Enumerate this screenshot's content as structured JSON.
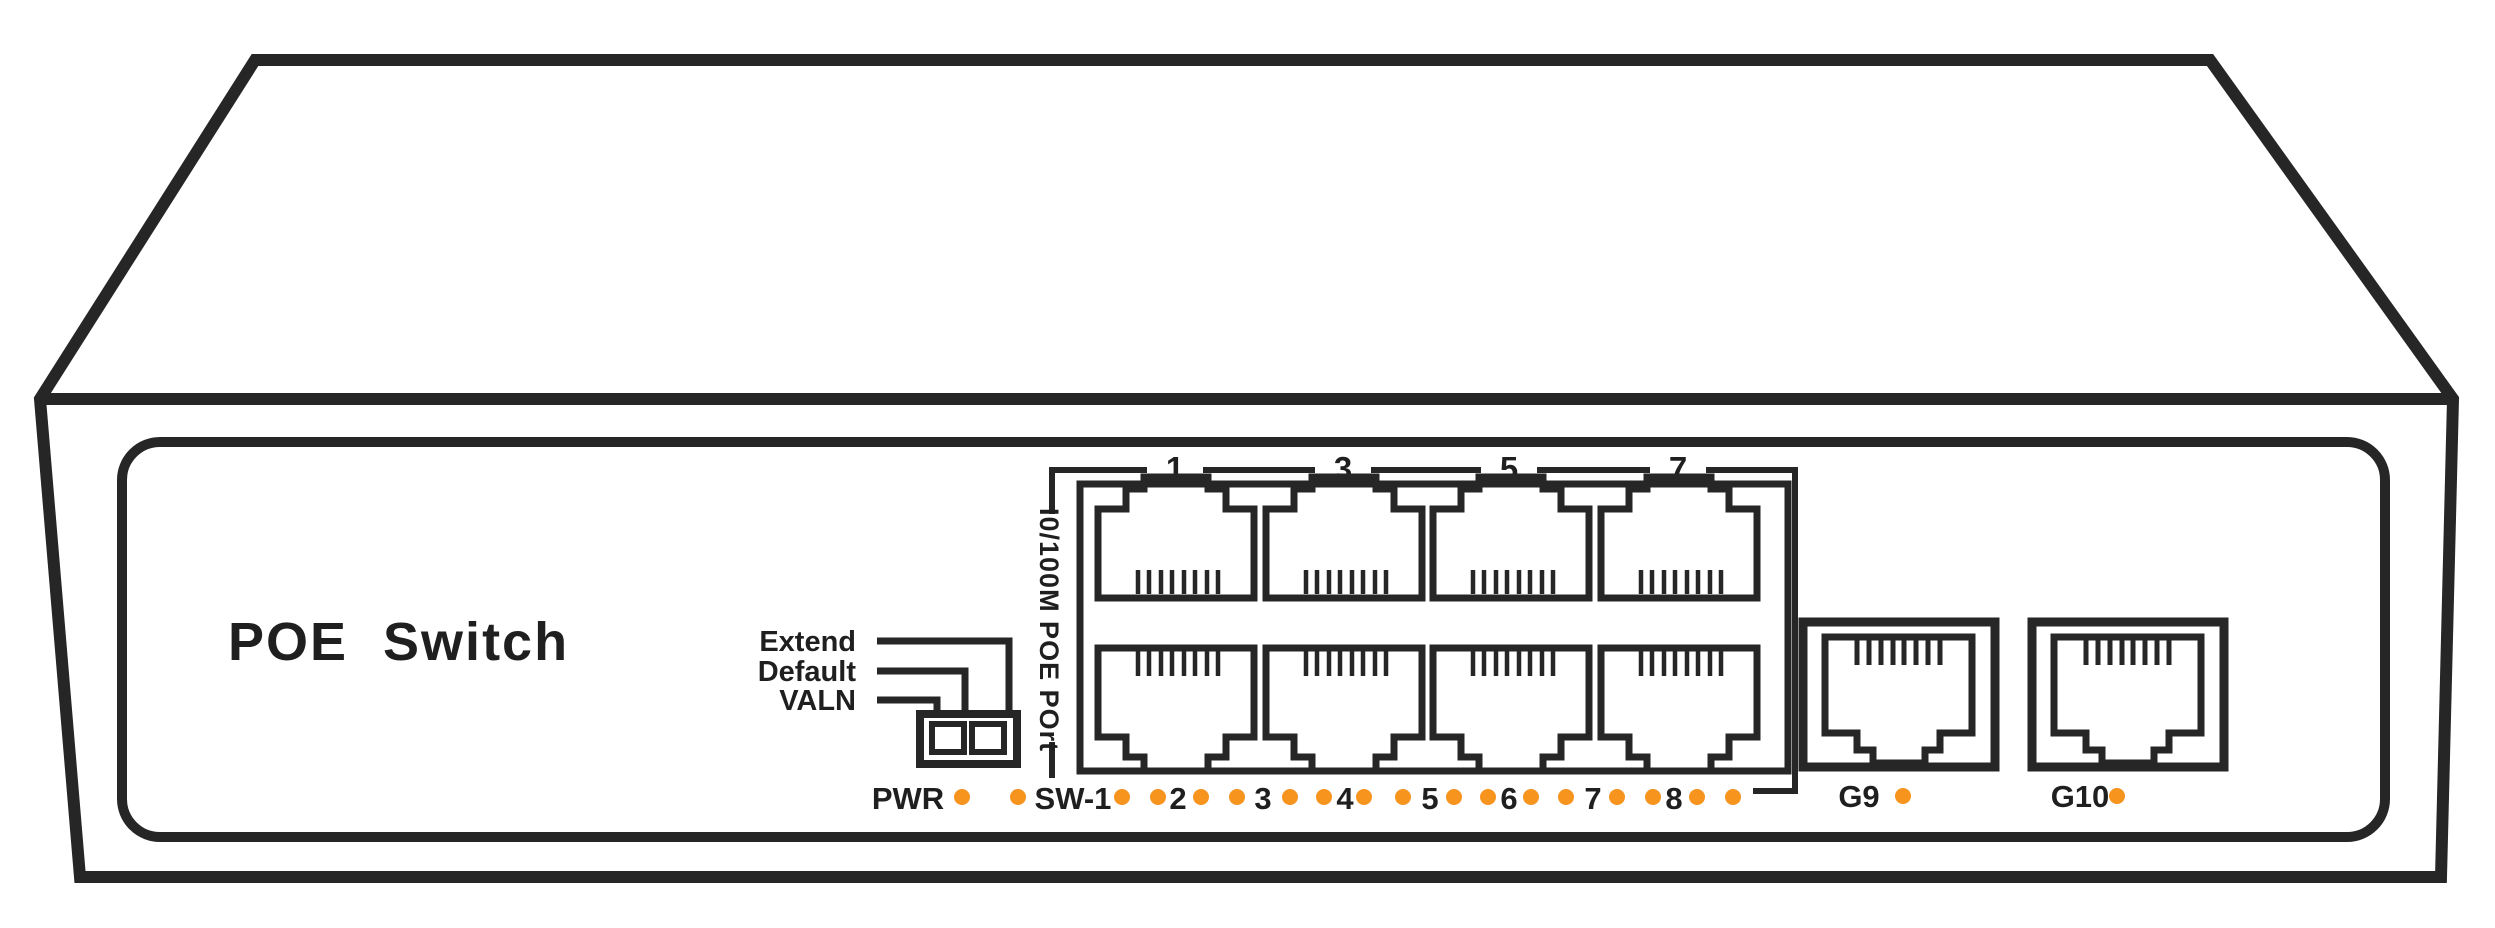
{
  "device": {
    "title": "POE Switch"
  },
  "mode_switch": {
    "labels": [
      "Extend",
      "Default",
      "VALN"
    ]
  },
  "port_block": {
    "vertical_label": "I0/100M POE POrt",
    "top_port_numbers": [
      "1",
      "3",
      "5",
      "7"
    ]
  },
  "leds": {
    "color": "#F7941E",
    "power_label": "PWR",
    "switch_label": "SW-1",
    "port_numbers": [
      "2",
      "3",
      "4",
      "5",
      "6",
      "7",
      "8"
    ]
  },
  "uplink_ports": {
    "labels": [
      "G9",
      "G10"
    ]
  }
}
